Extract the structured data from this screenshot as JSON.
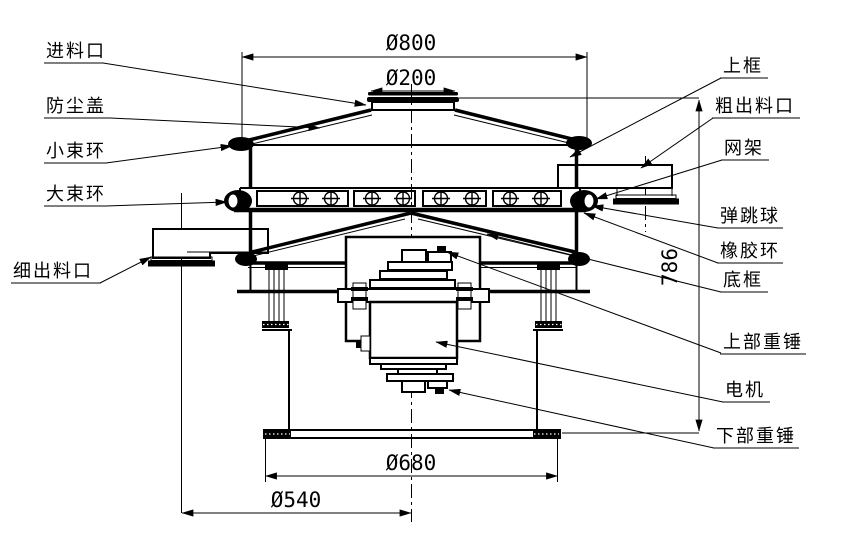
{
  "diagram": {
    "type": "engineering-drawing",
    "subject": "rotary vibrating sieve separator cross-section",
    "background_color": "#ffffff",
    "line_color": "#000000",
    "part_labels": {
      "feed_inlet": "进料口",
      "dust_cover": "防尘盖",
      "small_clamp_ring": "小束环",
      "large_clamp_ring": "大束环",
      "fine_outlet": "细出料口",
      "upper_frame": "上框",
      "coarse_outlet": "粗出料口",
      "mesh_frame": "网架",
      "bouncing_ball": "弹跳球",
      "rubber_ring": "橡胶环",
      "bottom_frame": "底框",
      "upper_weight": "上部重锤",
      "motor": "电机",
      "lower_weight": "下部重锤"
    },
    "dimensions": {
      "top_diameter": "Ø800",
      "inlet_diameter": "Ø200",
      "base_diameter": "Ø680",
      "base_circle_diameter": "Ø540",
      "total_height": "786"
    }
  }
}
